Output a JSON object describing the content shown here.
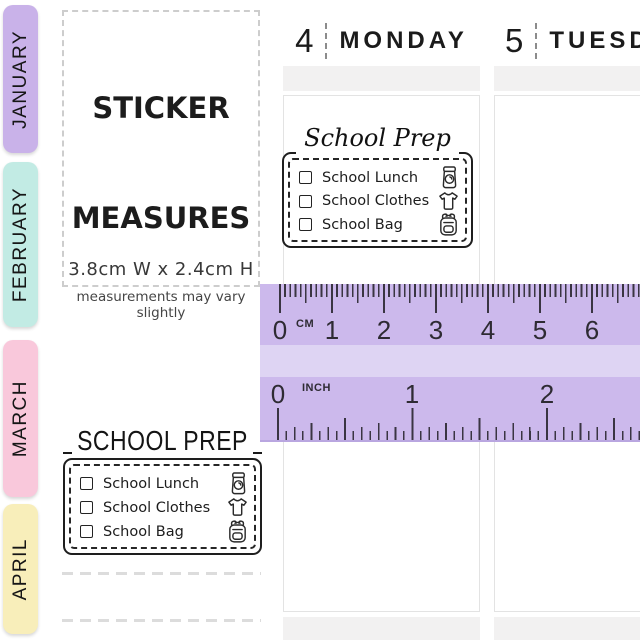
{
  "month_tabs": [
    {
      "label": "JANUARY",
      "color": "#c9b2e9"
    },
    {
      "label": "FEBRUARY",
      "color": "#c2ebe4"
    },
    {
      "label": "MARCH",
      "color": "#f9c8db"
    },
    {
      "label": "APRIL",
      "color": "#f8eeba"
    }
  ],
  "measure_card": {
    "title_line1": "STICKER",
    "title_line2": "MEASURES",
    "dimensions": "3.8cm W  x 2.4cm H",
    "disclaimer": "measurements may vary slightly"
  },
  "day_columns": [
    {
      "number": "4",
      "name": "MONDAY"
    },
    {
      "number": "5",
      "name": "TUESDAY"
    }
  ],
  "sticker": {
    "script_title": "School Prep",
    "caps_title": "SCHOOL PREP",
    "items": [
      {
        "label": "School Lunch",
        "icon": "lunch-bag-icon"
      },
      {
        "label": "School Clothes",
        "icon": "tshirt-icon"
      },
      {
        "label": "School Bag",
        "icon": "backpack-icon"
      }
    ]
  },
  "ruler": {
    "cm_unit": "CM",
    "inch_unit": "INCH",
    "cm_marks": [
      "0",
      "1",
      "2",
      "3",
      "4",
      "5",
      "6"
    ],
    "inch_marks": [
      "0",
      "1",
      "2"
    ],
    "body_color": "#ccb9ec",
    "band_color": "#ded4f3",
    "tick_color": "#3a3542"
  }
}
